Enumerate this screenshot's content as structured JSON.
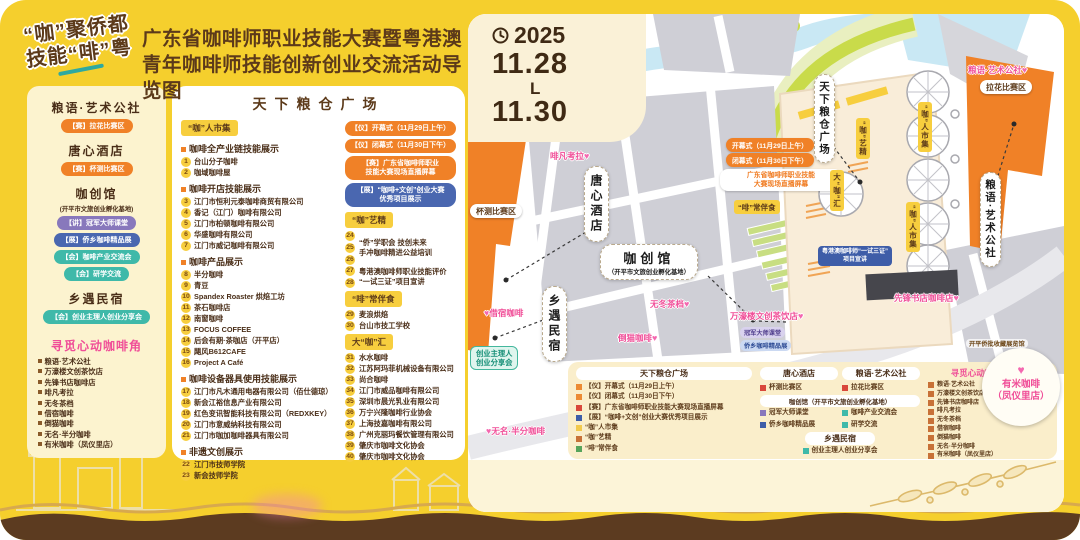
{
  "logo": {
    "line1": "“咖”聚侨都",
    "line2": "技能“啡”粤"
  },
  "header": {
    "title_line1": "广东省咖啡师职业技能大赛暨粤港澳",
    "title_line2": "青年咖啡师技能创新创业交流活动导览图"
  },
  "colors": {
    "canvas": "#F5CF2D",
    "brown_text": "#5C3A1A",
    "orange": "#F08127",
    "pink": "#F04E98",
    "teal": "#3FB9A9",
    "purple": "#8878BC",
    "blue": "#4A67B0",
    "yellow_tag": "#F7CE3E",
    "legend_bg": "#FAEECB",
    "wave_brown": "#5C3B20"
  },
  "sidebar": {
    "sections": [
      {
        "title": "粮语·艺术公社",
        "badges": [
          {
            "text": "【赛】拉花比赛区",
            "type": "orange"
          }
        ]
      },
      {
        "title": "唐心酒店",
        "badges": [
          {
            "text": "【赛】杯测比赛区",
            "type": "orange"
          }
        ]
      },
      {
        "title": "咖创馆",
        "subtitle": "(开平市文旅创业孵化基地)",
        "badges": [
          {
            "text": "【讲】冠军大师课堂",
            "type": "purple"
          },
          {
            "text": "【展】侨乡咖啡精品展",
            "type": "blue"
          },
          {
            "text": "【会】咖啡产业交流会",
            "type": "teal"
          },
          {
            "text": "【会】研学交流",
            "type": "teal"
          }
        ]
      },
      {
        "title": "乡遇民宿",
        "badges": [
          {
            "text": "【会】创业主理人创业分享会",
            "type": "teal"
          }
        ]
      }
    ],
    "coffee_corner": {
      "title": "寻觅心动咖啡角",
      "items": [
        "粮语·艺术公社",
        "万濠楼文创茶饮店",
        "先锋书店咖啡店",
        "啡凡考拉",
        "无冬茶档",
        "借宿咖啡",
        "倒猫咖啡",
        "无名·半分咖啡",
        "有米咖啡（凤仪里店）"
      ]
    }
  },
  "program": {
    "title": "天下粮仓广场",
    "market_tag": "“咖”人市集",
    "left_sections": [
      {
        "heading": "咖啡全产业链技能展示",
        "items": [
          {
            "n": "1",
            "t": "台山分子咖啡"
          },
          {
            "n": "2",
            "t": "咖域咖啡屋"
          }
        ]
      },
      {
        "heading": "咖啡开店技能展示",
        "items": [
          {
            "n": "3",
            "t": "江门市恒利元泰咖啡商贸有限公司"
          },
          {
            "n": "4",
            "t": "香记（江门）咖啡有限公司"
          },
          {
            "n": "5",
            "t": "江门市柏顿咖啡有限公司"
          },
          {
            "n": "6",
            "t": "华盛咖啡有限公司"
          },
          {
            "n": "7",
            "t": "江门市威记咖啡有限公司"
          }
        ]
      },
      {
        "heading": "咖啡产品展示",
        "items": [
          {
            "n": "8",
            "t": "半分咖啡"
          },
          {
            "n": "9",
            "t": "青豆"
          },
          {
            "n": "10",
            "t": "Spandex Roaster 烘焙工坊"
          },
          {
            "n": "11",
            "t": "茶石咖啡店"
          },
          {
            "n": "12",
            "t": "南窗咖啡"
          },
          {
            "n": "13",
            "t": "FOCUS COFFEE"
          },
          {
            "n": "14",
            "t": "后会有期·茶咖店（开平店）"
          },
          {
            "n": "15",
            "t": "飓风B612CAFE"
          },
          {
            "n": "16",
            "t": "Project A Café"
          }
        ]
      },
      {
        "heading": "咖啡设备器具使用技能展示",
        "items": [
          {
            "n": "17",
            "t": "江门市凡木通用电器有限公司（佰仕德琼）"
          },
          {
            "n": "18",
            "t": "新会江裕信息产业有限公司"
          },
          {
            "n": "19",
            "t": "红色变讯智能科技有限公司（REDXKEY）"
          },
          {
            "n": "20",
            "t": "江门市意威纳科技有限公司"
          },
          {
            "n": "21",
            "t": "江门市咖加咖啡器具有限公司"
          }
        ]
      },
      {
        "heading": "非遗文创展示",
        "items": [
          {
            "n": "22",
            "t": "江门市技师学院"
          },
          {
            "n": "23",
            "t": "新会技师学院"
          }
        ]
      }
    ],
    "right": {
      "pills": [
        {
          "type": "orange",
          "lines": [
            "【仪】开幕式（11月29日上午）"
          ]
        },
        {
          "type": "orange",
          "lines": [
            "【仪】闭幕式（11月30日下午）"
          ]
        },
        {
          "type": "orange",
          "lines": [
            "【赛】广东省咖啡师职业",
            "技能大赛现场直播屏幕"
          ]
        },
        {
          "type": "blue",
          "lines": [
            "【展】“咖啡+文创”创业大赛",
            "优秀项目展示"
          ]
        }
      ],
      "groups": [
        {
          "tag": "“咖”艺精",
          "entries": [
            {
              "nums": [
                "24",
                "25",
                "26"
              ],
              "lines": [
                "“侨”学职会 技创未来",
                "手冲咖啡精进公益培训"
              ]
            },
            {
              "nums": [
                "27",
                "28"
              ],
              "lines": [
                "粤港澳咖啡师职业技能评价",
                "“一试三证”项目宣讲"
              ]
            }
          ]
        },
        {
          "tag": "“啡”常伴食",
          "entries": [
            {
              "nums": [
                "29"
              ],
              "lines": [
                "麦浪烘焙"
              ]
            },
            {
              "nums": [
                "30"
              ],
              "lines": [
                "台山市技工学校"
              ]
            }
          ]
        },
        {
          "tag": "大“咖”汇",
          "entries": [
            {
              "nums": [
                "31"
              ],
              "lines": [
                "水水咖啡"
              ]
            },
            {
              "nums": [
                "32"
              ],
              "lines": [
                "江苏阿玛菲机械设备有限公司"
              ]
            },
            {
              "nums": [
                "33"
              ],
              "lines": [
                "尚合咖啡"
              ]
            },
            {
              "nums": [
                "34"
              ],
              "lines": [
                "江门市威品咖啡有限公司"
              ]
            },
            {
              "nums": [
                "35"
              ],
              "lines": [
                "深圳市晨光乳业有限公司"
              ]
            },
            {
              "nums": [
                "36"
              ],
              "lines": [
                "万宁兴隆咖啡行业协会"
              ]
            },
            {
              "nums": [
                "37"
              ],
              "lines": [
                "上海技嘉咖啡有限公司"
              ]
            },
            {
              "nums": [
                "38"
              ],
              "lines": [
                "广州克丽玛餐饮管理有限公司"
              ]
            },
            {
              "nums": [
                "39"
              ],
              "lines": [
                "肇庆市咖啡文化协会"
              ]
            },
            {
              "nums": [
                "40"
              ],
              "lines": [
                "肇庆市咖啡文化协会"
              ]
            }
          ]
        }
      ]
    }
  },
  "map": {
    "date": {
      "year": "2025",
      "from": "11.28",
      "sep": "L",
      "to": "11.30"
    },
    "labels": {
      "tangxin": "唐心酒店",
      "xiangyu": "乡遇民宿",
      "tianxia": "天下粮仓广场",
      "liangyu_right": "粮语·艺术公社",
      "kachuang1": "咖创馆",
      "kachuang2": "（开平市文旅创业孵化基地）",
      "cup_test": "杯测比赛区",
      "latte_art": "拉花比赛区"
    },
    "pink": {
      "feifan": "啡凡考拉",
      "liangyu": "粮语·艺术公社",
      "wudong": "无冬茶档",
      "daomao": "倒猫咖啡",
      "jiesu": "借宿咖啡",
      "wuming": "无名·半分咖啡",
      "xianfeng": "先锋书店咖啡店",
      "wanhao": "万濠楼文创茶饮店"
    },
    "orange_notes": {
      "open": "开幕式（11月29日上午）",
      "close": "闭幕式（11月30日下午）",
      "live1": "广东省咖啡师职业技能",
      "live2": "大赛现场直播屏幕"
    },
    "yellow_tags": {
      "market": "“咖”人市集",
      "dakahui": "大“咖”汇",
      "kayijing": "“咖”艺精",
      "feichang": "“啡”常伴食"
    },
    "teal_notes": {
      "share1": "创业主理人",
      "share2": "创业分享会",
      "champion": "冠军大师课堂",
      "qiaoxiang": "侨乡咖啡精品展",
      "blue1": "粤港澳咖啡师“一试三证”",
      "blue2": "项目宣讲"
    },
    "callout": {
      "caption": "开平侨批收藏展览馆",
      "name": "有米咖啡",
      "branch": "（凤仪里店）"
    },
    "legend": {
      "col1": {
        "header": "天下粮仓广场",
        "rows": [
          {
            "type": "orange",
            "text": "【仪】开幕式（11月29日上午）"
          },
          {
            "type": "orange",
            "text": "【仪】闭幕式（11月30日下午）"
          },
          {
            "type": "red",
            "text": "【赛】广东省咖啡师职业技能大赛现场直播屏幕"
          },
          {
            "type": "blue",
            "text": "【展】“咖啡+文创”创业大赛优秀项目展示"
          },
          {
            "type": "yellow",
            "text": "“咖”人市集"
          },
          {
            "type": "brown",
            "text": "“咖”艺精"
          },
          {
            "type": "green",
            "text": "“啡”常伴食"
          }
        ]
      },
      "col2": {
        "h1": "唐心酒店",
        "h2": "粮语·艺术公社",
        "i1": "杯测比赛区",
        "i2": "拉花比赛区",
        "h3": "咖创馆（开平市文旅创业孵化基地）",
        "i3": "冠军大师课堂",
        "i4": "咖啡产业交流会",
        "i5": "侨乡咖啡精品展",
        "i6": "研学交流",
        "h4": "乡遇民宿",
        "i7": "创业主理人创业分享会"
      },
      "col3": {
        "header": "寻觅心动咖啡角"
      }
    }
  }
}
